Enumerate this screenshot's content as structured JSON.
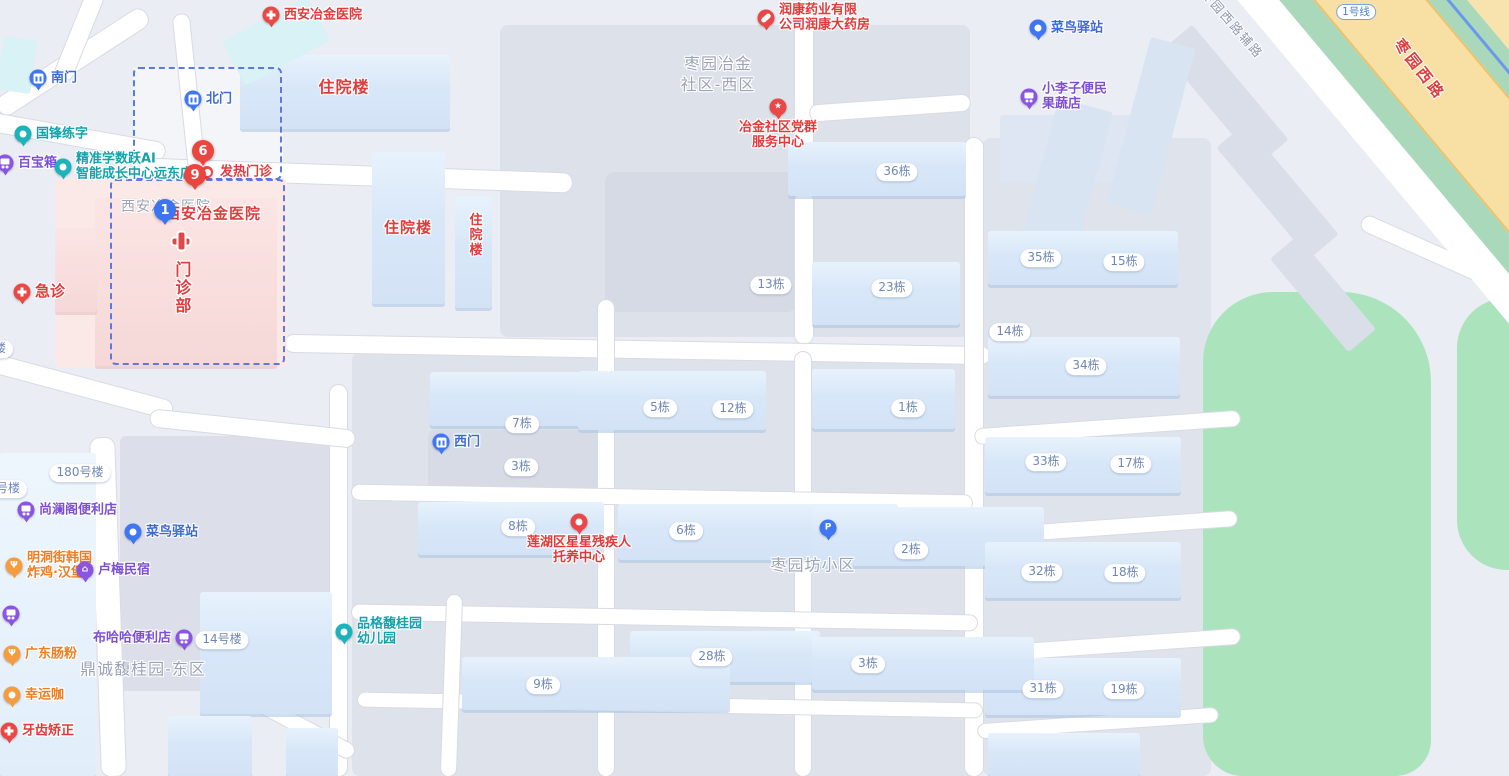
{
  "map": {
    "colors": {
      "background": "#eaedf3",
      "building_blue": "#d9e7f8",
      "block_grey": "#dde1ea",
      "hospital_pink": "#fbe9e8",
      "park_green": "#abe3bd",
      "main_road_yellow": "#f8dfa3",
      "verge_green": "#a9d9ba",
      "metro_blue": "#6b98ec",
      "road_white": "#ffffff",
      "poi_red": "#ea4747",
      "poi_blue": "#3f76f3",
      "poi_purple": "#8a55e0",
      "poi_teal": "#1cb3bb",
      "poi_orange": "#f59b40",
      "badge_text": "#6e86b6",
      "area_text": "#9ba4b4"
    },
    "numbered_markers": [
      {
        "value": "6",
        "color": "red",
        "x": 203,
        "y": 151
      },
      {
        "value": "9",
        "color": "red",
        "x": 195,
        "y": 175
      },
      {
        "value": "1",
        "color": "blue",
        "x": 165,
        "y": 210
      }
    ],
    "pois": [
      {
        "id": "gate-south",
        "lines": [
          "南门"
        ],
        "x": 38,
        "y": 78,
        "pin": true,
        "glyph": "gate",
        "color": "blue"
      },
      {
        "id": "gate-north",
        "lines": [
          "北门"
        ],
        "x": 193,
        "y": 99,
        "pin": true,
        "glyph": "gate",
        "color": "blue"
      },
      {
        "id": "gate-west",
        "lines": [
          "西门"
        ],
        "x": 441,
        "y": 442,
        "pin": true,
        "glyph": "gate",
        "color": "blue"
      },
      {
        "id": "guofeng-lianzi",
        "lines": [
          "国锋练字"
        ],
        "x": 23,
        "y": 134,
        "pin": true,
        "glyph": "dot",
        "color": "teal"
      },
      {
        "id": "baibaoxiang",
        "lines": [
          "百宝箱"
        ],
        "x": 5,
        "y": 163,
        "pin": true,
        "glyph": "cart",
        "color": "purple"
      },
      {
        "id": "jingzhun-ai-center",
        "lines": [
          "精准学数跃AI",
          "智能成长中心远东店"
        ],
        "x": 63,
        "y": 167,
        "pin": true,
        "glyph": "dot",
        "color": "teal"
      },
      {
        "id": "fever-clinic",
        "lines": [
          "发热门诊"
        ],
        "x": 207,
        "y": 172,
        "pin": true,
        "glyph": "dot",
        "color": "red",
        "small": true
      },
      {
        "id": "xian-metallurgical-hospital",
        "lines": [
          "西安冶金医院"
        ],
        "x": 271,
        "y": 15,
        "pin": true,
        "glyph": "cross",
        "color": "red"
      },
      {
        "id": "emergency-dept",
        "lines": [
          "急诊"
        ],
        "x": 22,
        "y": 292,
        "pin": true,
        "glyph": "cross",
        "color": "red",
        "size": 15
      },
      {
        "id": "runkang-pharmacy",
        "lines": [
          "润康药业有限",
          "公司润康大药房"
        ],
        "x": 766,
        "y": 18,
        "pin": true,
        "glyph": "capsule",
        "color": "red"
      },
      {
        "id": "party-service-center",
        "lines": [
          "冶金社区党群",
          "服务中心"
        ],
        "x": 778,
        "y": 107,
        "pin": true,
        "glyph": "star",
        "color": "red",
        "label": "below"
      },
      {
        "id": "cainiao-station-north",
        "lines": [
          "菜鸟驿站"
        ],
        "x": 1038,
        "y": 28,
        "pin": true,
        "glyph": "dot",
        "color": "blue"
      },
      {
        "id": "xiaolizi-grocery",
        "lines": [
          "小李子便民",
          "果蔬店"
        ],
        "x": 1029,
        "y": 97,
        "pin": true,
        "glyph": "cart",
        "color": "purple"
      },
      {
        "id": "parking-lot",
        "x": 828,
        "y": 528,
        "pin": true,
        "glyph": "p",
        "color": "blue"
      },
      {
        "id": "lianhu-star-care-center",
        "lines": [
          "莲湖区星星残疾人",
          "托养中心"
        ],
        "x": 579,
        "y": 522,
        "pin": true,
        "glyph": "dot",
        "color": "red",
        "label": "below"
      },
      {
        "id": "pinge-kindergarten",
        "lines": [
          "品格馥桂园",
          "幼儿园"
        ],
        "x": 344,
        "y": 632,
        "pin": true,
        "glyph": "dot",
        "color": "teal"
      },
      {
        "id": "shanglange-store",
        "lines": [
          "尚澜阁便利店"
        ],
        "x": 26,
        "y": 510,
        "pin": true,
        "glyph": "cart",
        "color": "purple"
      },
      {
        "id": "mingdong-korean-chicken",
        "lines": [
          "明洞街韩国",
          "炸鸡·汉堡"
        ],
        "x": 14,
        "y": 566,
        "pin": true,
        "glyph": "fork",
        "color": "orange"
      },
      {
        "id": "lumei-homestay",
        "lines": [
          "卢梅民宿"
        ],
        "x": 85,
        "y": 570,
        "pin": true,
        "glyph": "house",
        "color": "purple"
      },
      {
        "id": "cainiao-station-south",
        "lines": [
          "菜鸟驿站"
        ],
        "x": 133,
        "y": 532,
        "pin": true,
        "glyph": "dot",
        "color": "blue"
      },
      {
        "id": "buhaha-store",
        "lines": [
          "布哈哈便利店"
        ],
        "x": 184,
        "y": 638,
        "pin": true,
        "glyph": "cart",
        "color": "purple",
        "label": "left"
      },
      {
        "id": "guangdong-changfen",
        "lines": [
          "广东肠粉"
        ],
        "x": 12,
        "y": 654,
        "pin": true,
        "glyph": "fork",
        "color": "orange"
      },
      {
        "id": "xingyunka-coffee",
        "lines": [
          "幸运咖"
        ],
        "x": 12,
        "y": 695,
        "pin": true,
        "glyph": "dot",
        "color": "orange"
      },
      {
        "id": "dental-orthodontics",
        "lines": [
          "牙齿矫正"
        ],
        "x": 9,
        "y": 731,
        "pin": true,
        "glyph": "cross",
        "color": "red"
      },
      {
        "id": "edge-store-marker",
        "x": 11,
        "y": 614,
        "pin": true,
        "glyph": "cart",
        "color": "purple"
      }
    ],
    "area_labels": [
      {
        "id": "zaoyuan-yejin-community-west",
        "lines": [
          "枣园冶金",
          "社区-西区"
        ],
        "x": 718,
        "y": 75,
        "style": "grey",
        "size": 16
      },
      {
        "id": "zaoyuanfang-community",
        "lines": [
          "枣园坊小区"
        ],
        "x": 813,
        "y": 566,
        "style": "grey",
        "size": 16
      },
      {
        "id": "dingcheng-fuguiyuan-east",
        "lines": [
          "鼎诚馥桂园-东区"
        ],
        "x": 143,
        "y": 670,
        "style": "grey",
        "size": 16
      },
      {
        "id": "icbc-bank-partial",
        "lines": [
          "中国工商银行"
        ],
        "x": 1122,
        "y": -7,
        "style": "grey",
        "size": 13
      },
      {
        "id": "inpatient-building-1",
        "lines": [
          "住院楼"
        ],
        "x": 344,
        "y": 88,
        "style": "red",
        "size": 16
      },
      {
        "id": "inpatient-building-2",
        "lines": [
          "住院楼"
        ],
        "x": 408,
        "y": 228,
        "style": "red",
        "size": 15
      },
      {
        "id": "inpatient-building-3",
        "lines": [
          "住院楼"
        ],
        "x": 473,
        "y": 235,
        "style": "red",
        "size": 13,
        "vertical": true
      },
      {
        "id": "outpatient-dept",
        "lines": [
          "门诊部"
        ],
        "x": 181,
        "y": 288,
        "style": "red",
        "size": 16,
        "vertical": true
      },
      {
        "id": "hospital-name-grey",
        "lines": [
          "西安冶金医院"
        ],
        "x": 166,
        "y": 207,
        "style": "grey",
        "size": 14
      },
      {
        "id": "hospital-name-red",
        "lines": [
          "西安冶金医院"
        ],
        "x": 213,
        "y": 214,
        "style": "red",
        "size": 15
      }
    ],
    "road_labels": [
      {
        "id": "zaoyuan-west-road",
        "text": "枣园西路",
        "x": 1420,
        "y": 69,
        "rotate": 52,
        "style": "red"
      },
      {
        "id": "zaoyuan-west-aux-road",
        "text": "枣园西路辅路",
        "x": 1233,
        "y": 23,
        "rotate": 49,
        "style": "grey"
      },
      {
        "id": "metro-line-1-badge",
        "text": "1号线",
        "x": 1356,
        "y": 12,
        "rotate": 0,
        "style": "badge"
      }
    ],
    "building_badges": [
      {
        "label": "36栋",
        "x": 897,
        "y": 172
      },
      {
        "label": "13栋",
        "x": 771,
        "y": 285
      },
      {
        "label": "23栋",
        "x": 892,
        "y": 288
      },
      {
        "label": "14栋",
        "x": 1010,
        "y": 332
      },
      {
        "label": "35栋",
        "x": 1041,
        "y": 258
      },
      {
        "label": "15栋",
        "x": 1124,
        "y": 262
      },
      {
        "label": "34栋",
        "x": 1086,
        "y": 366
      },
      {
        "label": "7栋",
        "x": 522,
        "y": 424
      },
      {
        "label": "3栋",
        "x": 521,
        "y": 467
      },
      {
        "label": "5栋",
        "x": 660,
        "y": 408
      },
      {
        "label": "12栋",
        "x": 733,
        "y": 409
      },
      {
        "label": "1栋",
        "x": 908,
        "y": 408
      },
      {
        "label": "8栋",
        "x": 518,
        "y": 527
      },
      {
        "label": "6栋",
        "x": 686,
        "y": 531
      },
      {
        "label": "2栋",
        "x": 911,
        "y": 550
      },
      {
        "label": "28栋",
        "x": 712,
        "y": 657
      },
      {
        "label": "3栋",
        "x": 868,
        "y": 664
      },
      {
        "label": "33栋",
        "x": 1046,
        "y": 462
      },
      {
        "label": "17栋",
        "x": 1131,
        "y": 464
      },
      {
        "label": "32栋",
        "x": 1042,
        "y": 572
      },
      {
        "label": "18栋",
        "x": 1125,
        "y": 573
      },
      {
        "label": "31栋",
        "x": 1043,
        "y": 689
      },
      {
        "label": "19栋",
        "x": 1124,
        "y": 690
      },
      {
        "label": "9栋",
        "x": 543,
        "y": 685
      },
      {
        "label": "180号楼",
        "x": 80,
        "y": 473
      },
      {
        "label": "14号楼",
        "x": 222,
        "y": 640
      },
      {
        "label": "楼",
        "x": 0,
        "y": 349
      },
      {
        "label": "号楼",
        "x": 8,
        "y": 489
      }
    ]
  }
}
